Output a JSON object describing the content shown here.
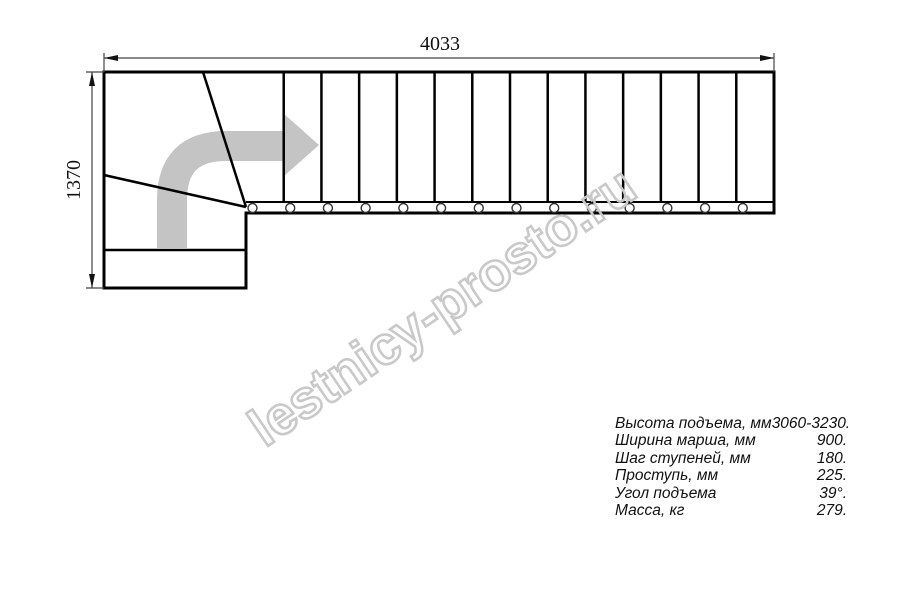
{
  "title": "Staircase plan drawing",
  "dimensions": {
    "total_length_mm": "4033",
    "total_width_mm": "1370"
  },
  "plan": {
    "straight_steps": 14,
    "balusters": 14,
    "winder_lines": 2
  },
  "watermark": {
    "text": "lestnicy-prosto.ru"
  },
  "specs": {
    "rows": [
      {
        "label": "Высота подъема, мм",
        "value": "3060-3230."
      },
      {
        "label": "Ширина марша, мм",
        "value": "900."
      },
      {
        "label": "Шаг ступеней, мм",
        "value": "180."
      },
      {
        "label": "Проступь, мм",
        "value": "225."
      },
      {
        "label": "Угол подъема",
        "value": "39°."
      },
      {
        "label": "Масса, кг",
        "value": "279."
      }
    ]
  },
  "colors": {
    "line": "#000000",
    "direction_arrow": "#c4c4c4",
    "watermark": "#c9c9c9",
    "text": "#111111"
  }
}
